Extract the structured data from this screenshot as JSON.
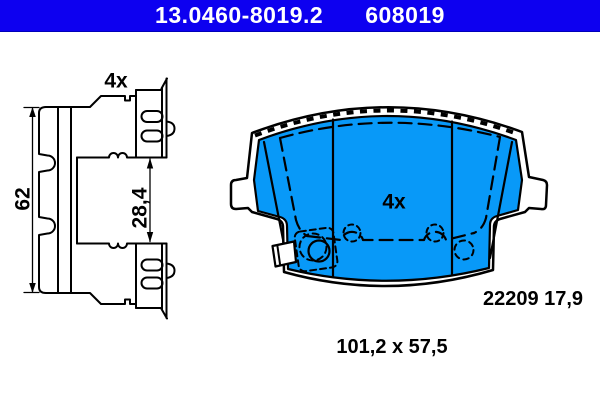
{
  "colors": {
    "headerBlue": "#0d00f0",
    "padBlue": "#0899f8",
    "ink": "#000000"
  },
  "header": {
    "part_number": "13.0460-8019.2",
    "catalog_number": "608019"
  },
  "accessory_drawing": {
    "quantity_label": "4x",
    "height_mm": "62",
    "depth_mm": "28,4"
  },
  "pad_drawing": {
    "quantity_label": "4x",
    "wva_thickness": "22209 17,9"
  },
  "footer": {
    "overall_dimensions": "101,2 x 57,5"
  }
}
